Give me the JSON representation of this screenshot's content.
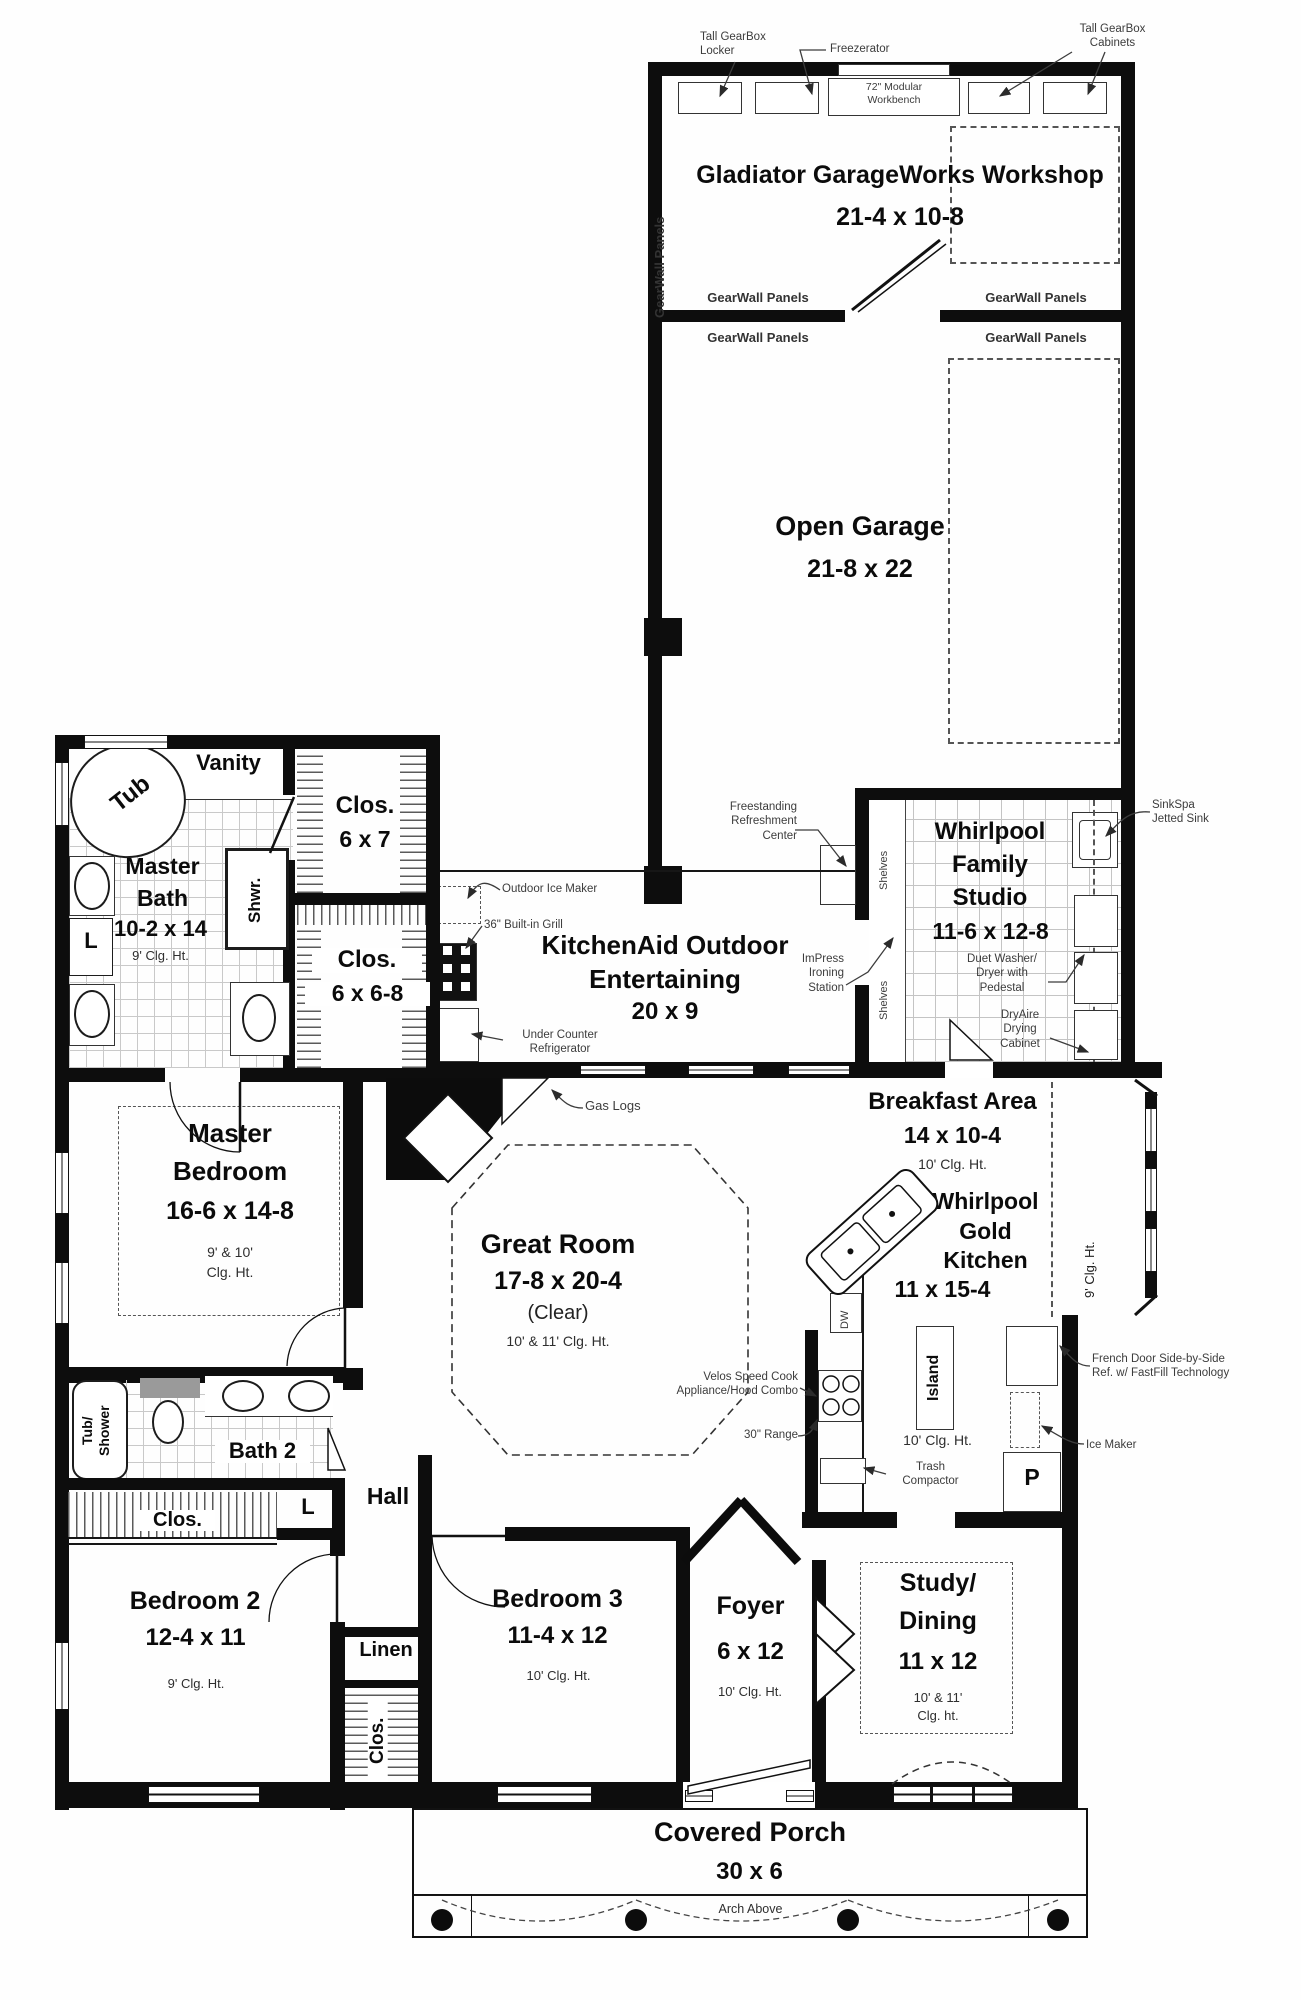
{
  "rooms": {
    "workshop": {
      "name": "Gladiator GarageWorks Workshop",
      "dim": "21-4 x 10-8"
    },
    "open_garage": {
      "name": "Open Garage",
      "dim": "21-8 x 22"
    },
    "family_studio": {
      "l1": "Whirlpool",
      "l2": "Family",
      "l3": "Studio",
      "dim": "11-6 x 12-8"
    },
    "outdoor_entertaining": {
      "l1": "KitchenAid Outdoor",
      "l2": "Entertaining",
      "dim": "20 x 9"
    },
    "master_bath": {
      "l1": "Master",
      "l2": "Bath",
      "dim": "10-2 x 14",
      "clg": "9' Clg. Ht."
    },
    "vanity": {
      "name": "Vanity"
    },
    "tub": {
      "name": "Tub"
    },
    "shower": {
      "name": "Shwr."
    },
    "laundry_master": {
      "name": "L"
    },
    "closet_6x7": {
      "name": "Clos.",
      "dim": "6 x 7"
    },
    "closet_6x68": {
      "name": "Clos.",
      "dim": "6 x 6-8"
    },
    "master_bedroom": {
      "l1": "Master",
      "l2": "Bedroom",
      "dim": "16-6 x 14-8",
      "clg1": "9' & 10'",
      "clg2": "Clg. Ht."
    },
    "great_room": {
      "name": "Great Room",
      "dim": "17-8 x 20-4",
      "clear": "(Clear)",
      "clg": "10' & 11' Clg. Ht."
    },
    "breakfast": {
      "name": "Breakfast Area",
      "dim": "14 x 10-4",
      "clg": "10' Clg. Ht."
    },
    "kitchen": {
      "l1": "Whirlpool",
      "l2": "Gold",
      "l3": "Kitchen",
      "dim": "11 x 15-4",
      "clg": "10' Clg. Ht."
    },
    "bath2": {
      "name": "Bath 2"
    },
    "tub_shower": {
      "l1": "Tub/",
      "l2": "Shower"
    },
    "hall": {
      "name": "Hall"
    },
    "closet_hall": {
      "name": "L"
    },
    "closet_bed2": {
      "name": "Clos."
    },
    "bedroom2": {
      "name": "Bedroom 2",
      "dim": "12-4 x 11",
      "clg": "9' Clg. Ht."
    },
    "bedroom3": {
      "name": "Bedroom 3",
      "dim": "11-4 x 12",
      "clg": "10' Clg. Ht."
    },
    "linen": {
      "name": "Linen"
    },
    "closet_bed3": {
      "name": "Clos."
    },
    "foyer": {
      "name": "Foyer",
      "dim": "6 x 12",
      "clg": "10' Clg. Ht."
    },
    "study_dining": {
      "l1": "Study/",
      "l2": "Dining",
      "dim": "11 x 12",
      "clg1": "10' & 11'",
      "clg2": "Clg. ht."
    },
    "porch": {
      "name": "Covered Porch",
      "dim": "30 x 6",
      "note": "Arch Above"
    }
  },
  "annotations": {
    "gearwall_panels": "GearWall Panels",
    "locker_l1": "Tall GearBox",
    "locker_l2": "Locker",
    "freezerator": "Freezerator",
    "workbench_l1": "72\" Modular",
    "workbench_l2": "Workbench",
    "cabinets_l1": "Tall GearBox",
    "cabinets_l2": "Cabinets",
    "refreshment_l1": "Freestanding",
    "refreshment_l2": "Refreshment",
    "refreshment_l3": "Center",
    "shelves": "Shelves",
    "sinkspa_l1": "SinkSpa",
    "sinkspa_l2": "Jetted Sink",
    "duet_l1": "Duet Washer/",
    "duet_l2": "Dryer with",
    "duet_l3": "Pedestal",
    "dryaire_l1": "DryAire",
    "dryaire_l2": "Drying",
    "dryaire_l3": "Cabinet",
    "impress_l1": "ImPress",
    "impress_l2": "Ironing",
    "impress_l3": "Station",
    "outdoor_ice_maker": "Outdoor Ice Maker",
    "builtin_grill": "36\" Built-in Grill",
    "under_counter_l1": "Under Counter",
    "under_counter_l2": "Refrigerator",
    "gas_logs": "Gas Logs",
    "velos_l1": "Velos Speed Cook",
    "velos_l2": "Appliance/Hood Combo",
    "range_30": "30\" Range",
    "trash_l1": "Trash",
    "trash_l2": "Compactor",
    "island": "Island",
    "dw": "DW",
    "pantry": "P",
    "bay_clg": "9' Clg. Ht.",
    "fridge_l1": "French Door Side-by-Side",
    "fridge_l2": "Ref. w/ FastFill Technology",
    "ice_maker": "Ice Maker"
  }
}
